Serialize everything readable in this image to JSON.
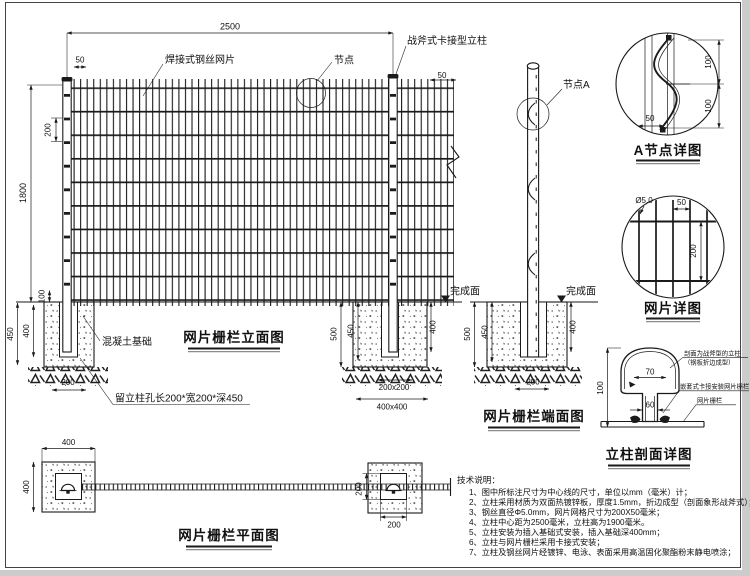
{
  "colors": {
    "line": "#1a1a1a",
    "background": "#ffffff",
    "frame": "#444444",
    "edge": "#cccccc"
  },
  "titles": {
    "elevation": "网片栅栏立面图",
    "end_view": "网片栅栏端面图",
    "plan": "网片栅栏平面图",
    "node_a_detail": "A节点详图",
    "mesh_detail": "网片详图",
    "post_section_detail": "立柱剖面详图"
  },
  "labels": {
    "welded_mesh": "焊接式钢丝网片",
    "node": "节点",
    "post_type": "战斧式卡接型立柱",
    "node_a": "节点A",
    "finish_elevation": "完成面",
    "finish_end": "完成面",
    "concrete_foundation": "混凝土基础",
    "post_hole": "留立柱孔长200*宽200*深450",
    "section_post_line1": "剖面为战斧型的立柱",
    "section_post_line2": "（钢板折边成型）",
    "section_clip": "嵌套式卡接安装网片栅栏",
    "section_mesh": "网片栅栏"
  },
  "dims": {
    "span": "2500",
    "height": "1800",
    "cell_v": "200",
    "gap_tl": "50",
    "gap_tr": "50",
    "embed": "100",
    "f1_450": "450",
    "f1_400": "400",
    "f1_hole": "200",
    "f2_500": "500",
    "f2_450": "450",
    "f2_400": "400",
    "f2_hole": "200x200",
    "f2_base": "400x400",
    "e_500": "500",
    "e_450": "450",
    "e_400": "400",
    "e_hole": "200",
    "a_100t": "100",
    "a_100b": "100",
    "a_50": "50",
    "md_dia": "Ø5.0",
    "md_50": "50",
    "md_200": "200",
    "s_100": "100",
    "s_70": "70",
    "s_60": "60",
    "p_400t": "400",
    "p_400l": "400",
    "p_200v": "200",
    "p_200b": "200"
  },
  "notes": {
    "heading": "技术说明：",
    "items": [
      "1、图中所标注尺寸为中心线的尺寸，单位以mm（毫米）计；",
      "2、立柱采用材质为双面热镀锌板，厚度1.5mm，折边成型（剖面象形战斧式）；",
      "3、钢丝直径Φ5.0mm，网片网格尺寸为200X50毫米；",
      "4、立柱中心距为2500毫米，立柱高为1900毫米。",
      "5、立柱安装为插入基础式安装，插入基础深400mm；",
      "6、立柱与网片栅栏采用卡接式安装；",
      "7、立柱及钢丝网片经镀锌、电泳、表面采用高温固化聚酯粉末静电喷涂；"
    ]
  }
}
